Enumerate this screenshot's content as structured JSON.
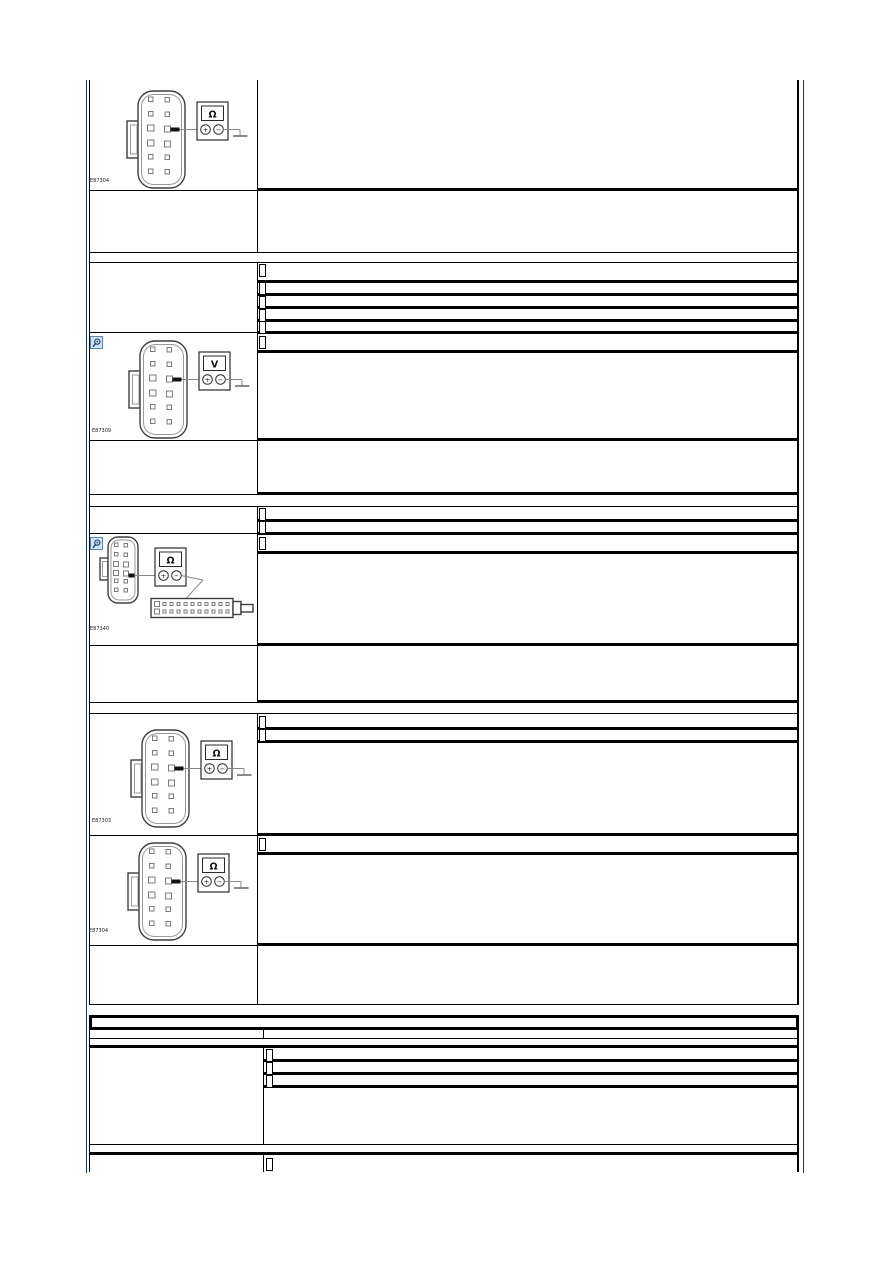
{
  "page": {
    "background": "#ffffff",
    "frame_color": "#17375e",
    "grid_color": "#000000",
    "zoom_icon_bg": "#cfe3f7",
    "zoom_icon_border": "#5b87b5"
  },
  "figures": [
    {
      "code": "E87304",
      "meter_symbol": "Ω"
    },
    {
      "code": "E87309",
      "meter_symbol": "V"
    },
    {
      "code": "E87340",
      "meter_symbol": "Ω"
    },
    {
      "code": "E87303",
      "meter_symbol": "Ω"
    },
    {
      "code": "E87304",
      "meter_symbol": "Ω"
    }
  ],
  "meter": {
    "plus": "+",
    "minus": "−"
  },
  "placeholder_rows": {
    "step1_list_rows": 5,
    "step2_top_rows": 1,
    "step2_list_rows": 2,
    "step3_top_rows": 1,
    "step4_top_rows": 2,
    "step5_top_rows": 1,
    "table2_list_rows": 3,
    "table2_footer_rows": 1
  }
}
